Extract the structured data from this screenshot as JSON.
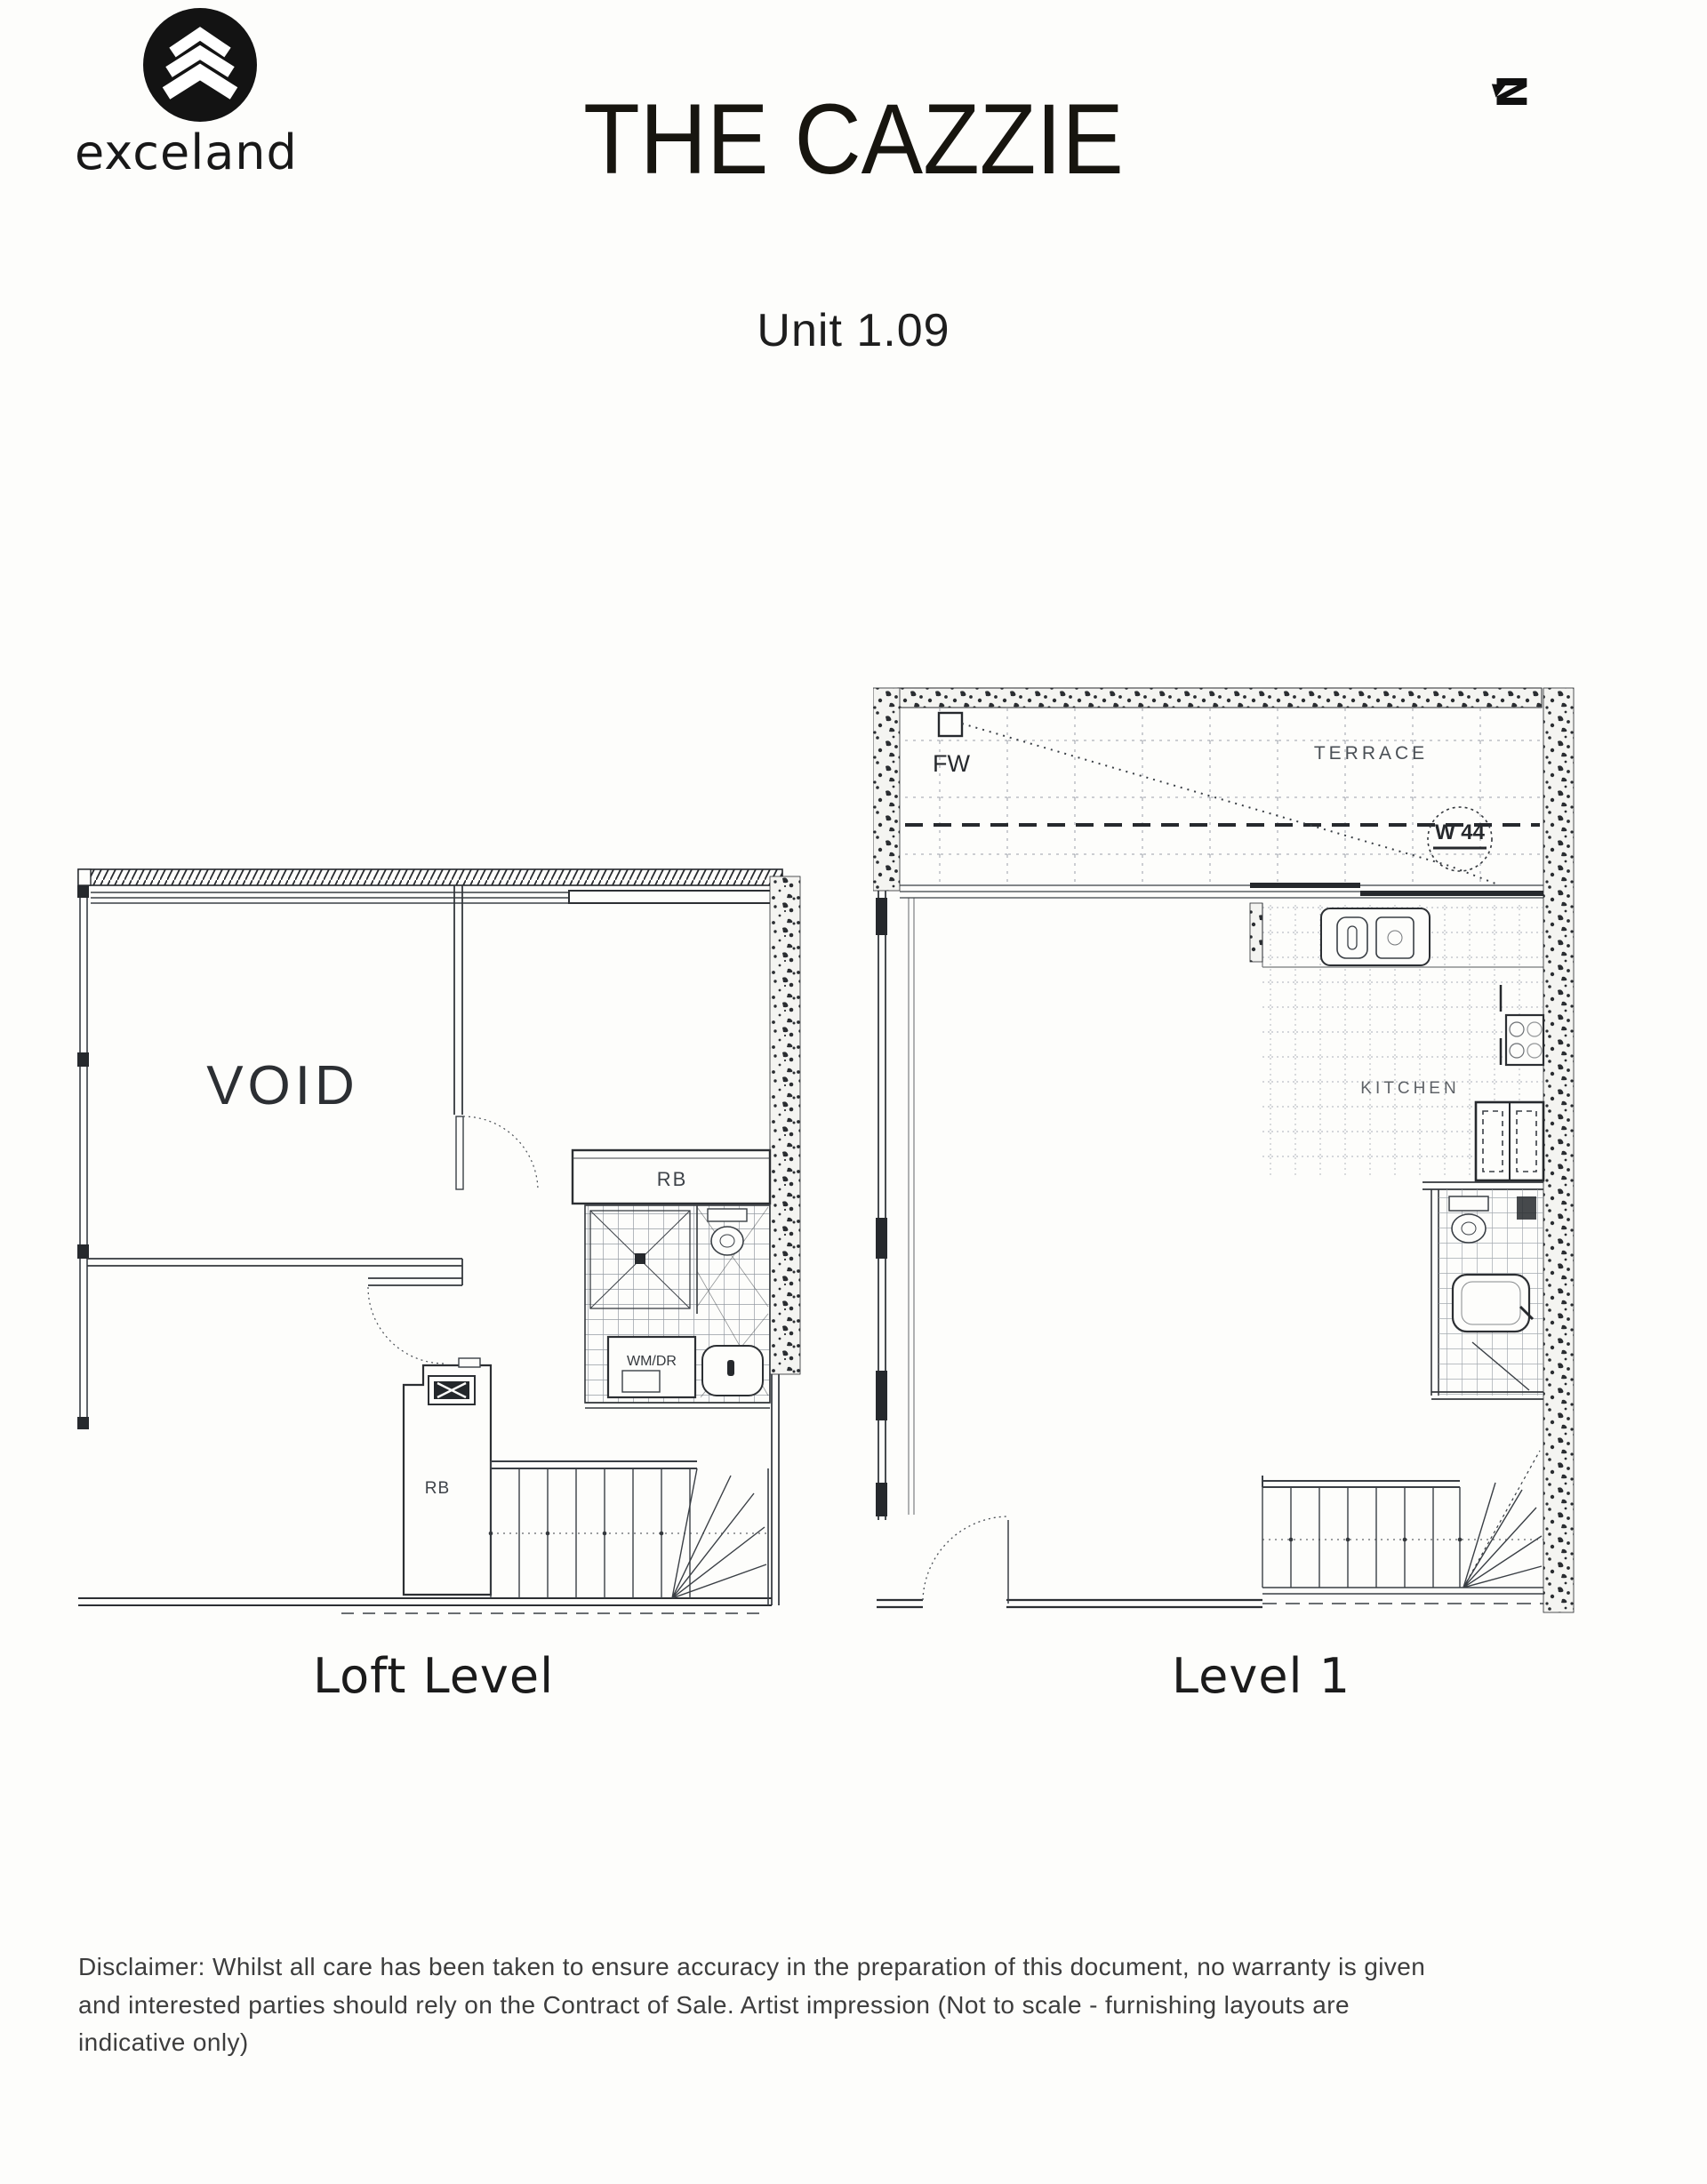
{
  "header": {
    "logo_text": "exceland",
    "title": "THE CAZZIE",
    "unit_label": "Unit 1.09",
    "north_letter": "N"
  },
  "loft_plan": {
    "caption": "Loft Level",
    "void_label": "VOID",
    "robe_label": "RB",
    "robe2_label": "RB",
    "laundry_label": "WM/DR"
  },
  "level1_plan": {
    "caption": "Level 1",
    "terrace_label": "TERRACE",
    "floor_waste_label": "FW",
    "window_tag": "W 44",
    "kitchen_label": "KITCHEN"
  },
  "footer": {
    "disclaimer_lines": [
      "Disclaimer: Whilst all care has been taken to ensure accuracy in the preparation of this document, no warranty is given",
      "and interested parties should rely on the Contract of Sale. Artist impression (Not to scale - furnishing layouts are",
      "indicative only)"
    ]
  },
  "colors": {
    "ink": "#26292d",
    "plan_line": "#3a3f45",
    "label_gray": "#4a4f55",
    "paper": "#fdfdfb"
  }
}
